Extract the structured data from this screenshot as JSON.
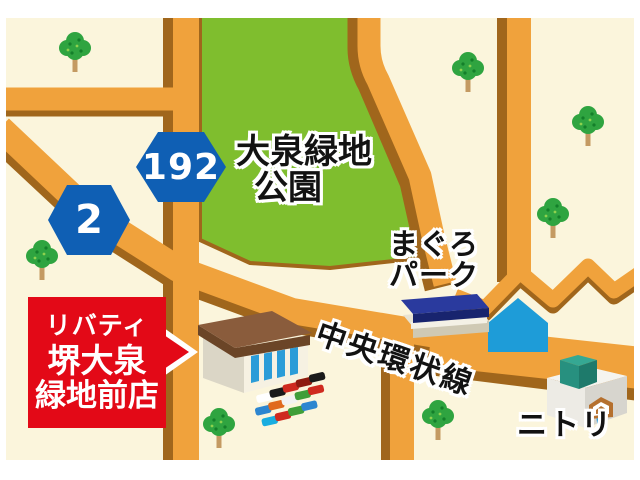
{
  "map": {
    "colors": {
      "background": "#FBF5DC",
      "road": "#F0A23C",
      "road_edge": "#A0661C",
      "park": "#7FBE2E",
      "badge_blue": "#0F5FB4",
      "callout_red": "#E30917",
      "water_blue": "#1E9CD8"
    },
    "labels": {
      "park_line1": "大泉緑地",
      "park_line2": "公園",
      "maguro_line1": "まぐろ",
      "maguro_line2": "パーク",
      "ring_road": "中央環状線",
      "nitori": "ニトリ"
    },
    "route_badges": [
      {
        "number": "192",
        "color": "#0F5FB4"
      },
      {
        "number": "2",
        "color": "#0F5FB4"
      }
    ],
    "store_callout": {
      "line1": "リバティ",
      "line2": "堺大泉",
      "line3": "緑地前店"
    }
  }
}
